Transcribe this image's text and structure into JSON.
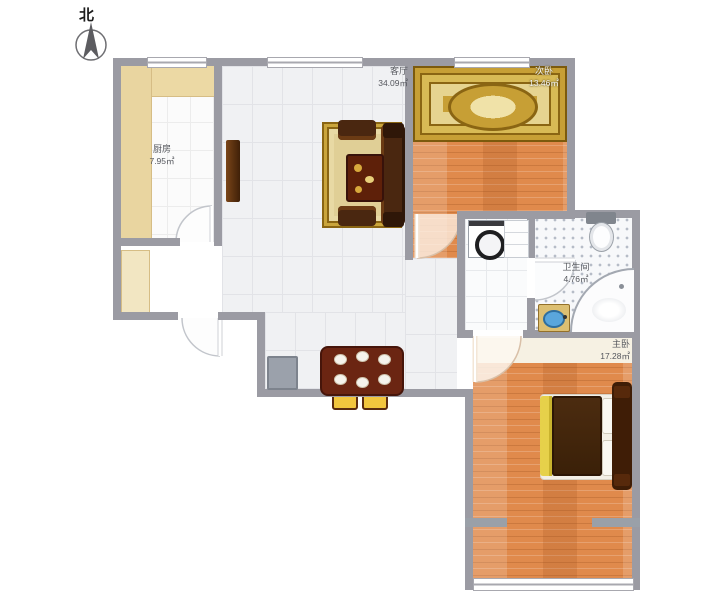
{
  "compass": {
    "label": "北"
  },
  "rooms": {
    "kitchen": {
      "name": "厨房",
      "area": "7.95㎡"
    },
    "living": {
      "name": "客厅",
      "area": "34.09㎡"
    },
    "bedroom2": {
      "name": "次卧",
      "area": "13.46㎡"
    },
    "bathroom": {
      "name": "卫生间",
      "area": "4.76㎡"
    },
    "master": {
      "name": "主卧",
      "area": "17.28㎡"
    }
  },
  "colors": {
    "wall": "#9b9ba3",
    "wood_floor": "#e08a4c",
    "tile_floor": "#f0f1f3",
    "counter_beige": "#ecd9a4",
    "carpet_gold": "#c79f35",
    "furniture_dark_brown": "#4a2710",
    "dining_table_red": "#6b2512",
    "chair_yellow": "#f2c63e",
    "basin_blue": "#5aa6dc"
  }
}
